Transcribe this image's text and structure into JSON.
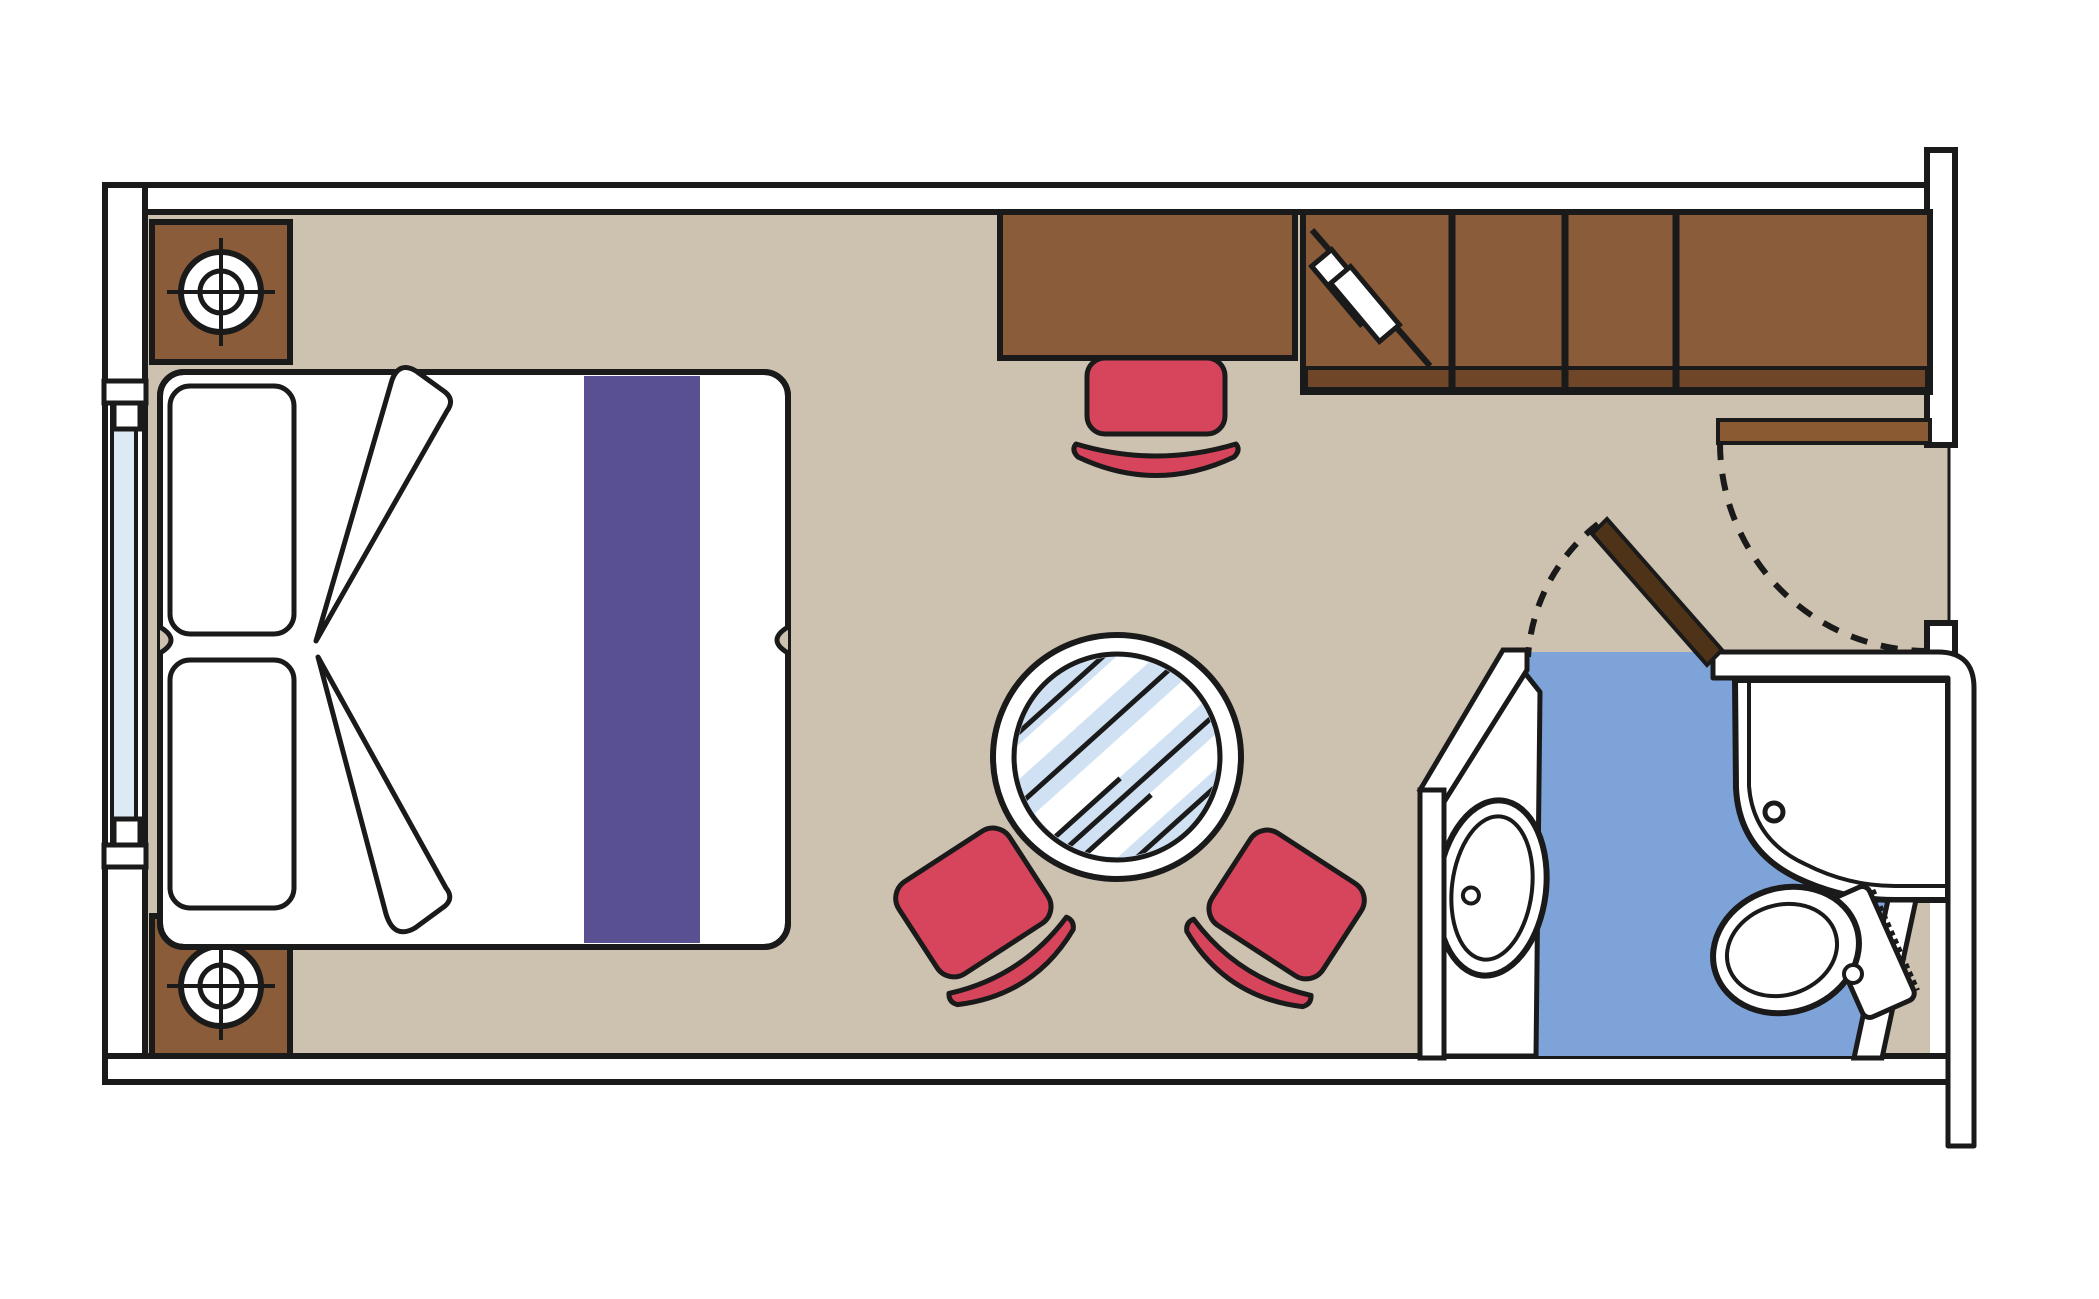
{
  "meta": {
    "title": "Cruise cabin floor plan",
    "diagram_type": "floorplan",
    "text_labels": []
  },
  "colors": {
    "background": "#ffffff",
    "line": "#1a1a1a",
    "wall_fill": "#ffffff",
    "floor": "#cdc2b0",
    "wood": "#8a5c39",
    "wood_dark": "#6f4628",
    "door_leaf": "#8a5a33",
    "bath_door_leaf": "#4f3319",
    "accent_red": "#d6455b",
    "runner_purple": "#585090",
    "bathroom_floor": "#7ea3d9",
    "window_glass": "#dceaf6",
    "table_glass": "#cfe1f3",
    "white": "#ffffff"
  },
  "elements": {
    "bed": "double-bed",
    "pillows": 2,
    "nightstands": 2,
    "lamp_icons": 2,
    "desk": "writing-desk",
    "desk_chair": "desk-chair",
    "wardrobe_compartments": 4,
    "ironing_board_icon": "ironing-board-icon",
    "stools": 2,
    "coffee_table": "round-glass-table",
    "entrance_door": "entrance-door-with-swing-arc",
    "bathroom": [
      "sink-basin",
      "shower-enclosure",
      "toilet"
    ],
    "balcony_window": "left-wall-window"
  }
}
